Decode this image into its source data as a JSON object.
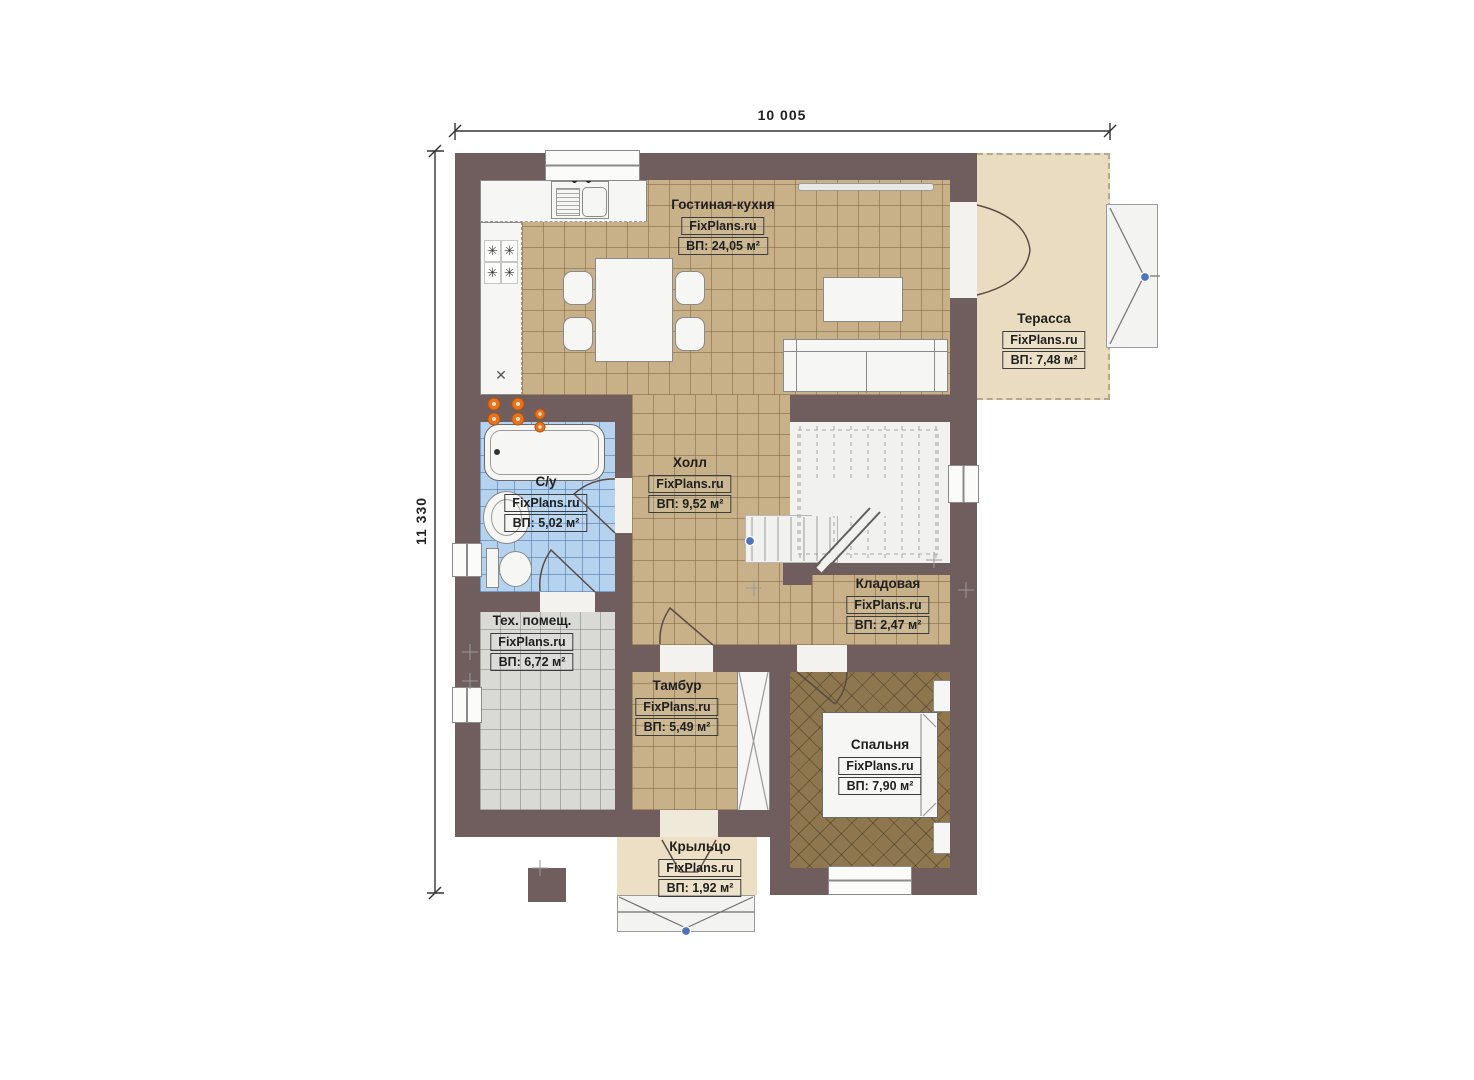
{
  "brand": "FixPlans.ru",
  "dimensions": {
    "width_mm": "10 005",
    "height_mm": "11 330"
  },
  "rooms": [
    {
      "name": "Гостиная-кухня",
      "brand": "FixPlans.ru",
      "area": "ВП: 24,05 м²"
    },
    {
      "name": "Терасса",
      "brand": "FixPlans.ru",
      "area": "ВП: 7,48 м²"
    },
    {
      "name": "С/у",
      "brand": "FixPlans.ru",
      "area": "ВП: 5,02 м²"
    },
    {
      "name": "Холл",
      "brand": "FixPlans.ru",
      "area": "ВП: 9,52 м²"
    },
    {
      "name": "Кладовая",
      "brand": "FixPlans.ru",
      "area": "ВП: 2,47 м²"
    },
    {
      "name": "Тех. помещ.",
      "brand": "FixPlans.ru",
      "area": "ВП: 6,72 м²"
    },
    {
      "name": "Тамбур",
      "brand": "FixPlans.ru",
      "area": "ВП: 5,49 м²"
    },
    {
      "name": "Спальня",
      "brand": "FixPlans.ru",
      "area": "ВП: 7,90 м²"
    },
    {
      "name": "Крыльцо",
      "brand": "FixPlans.ru",
      "area": "ВП: 1,92 м²"
    }
  ],
  "icons": {
    "burner": "✳",
    "utility_cross": "✕"
  },
  "colors": {
    "wall": "#6f5e5d",
    "tile_tan": "#c8b088",
    "tile_blue": "#b5d3ef",
    "tile_grey": "#d9d9d6",
    "floor_bedroom": "#8e774f",
    "deck_beige": "#e9dcc1",
    "marker_blue": "#4f74bf",
    "riser_orange": "#e8731e"
  }
}
